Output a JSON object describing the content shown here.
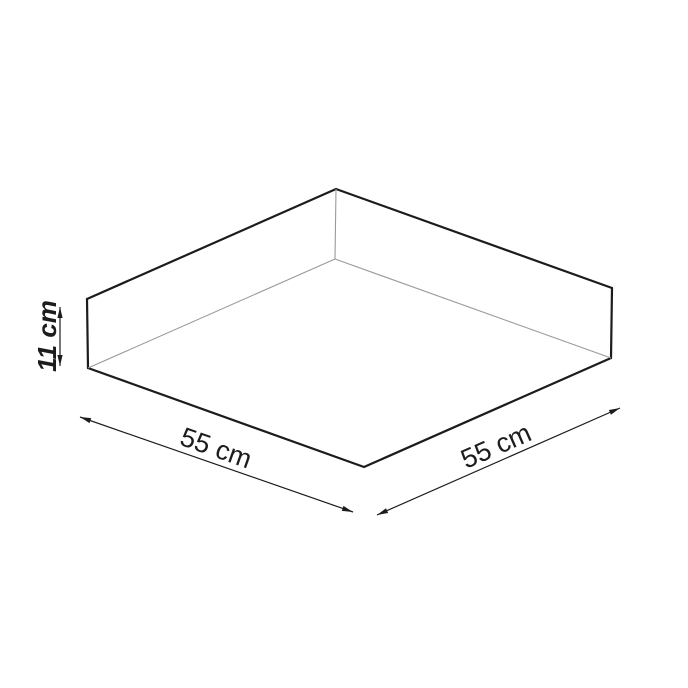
{
  "diagram": {
    "labels": {
      "height": "11 cm",
      "width_left": "55 cm",
      "width_right": "55 cm"
    },
    "colors": {
      "background": "#ffffff",
      "outline": "#1c1c1c",
      "inner_edge": "#9a9a9a",
      "dimension": "#1c1c1c",
      "text": "#1c1c1c"
    }
  }
}
